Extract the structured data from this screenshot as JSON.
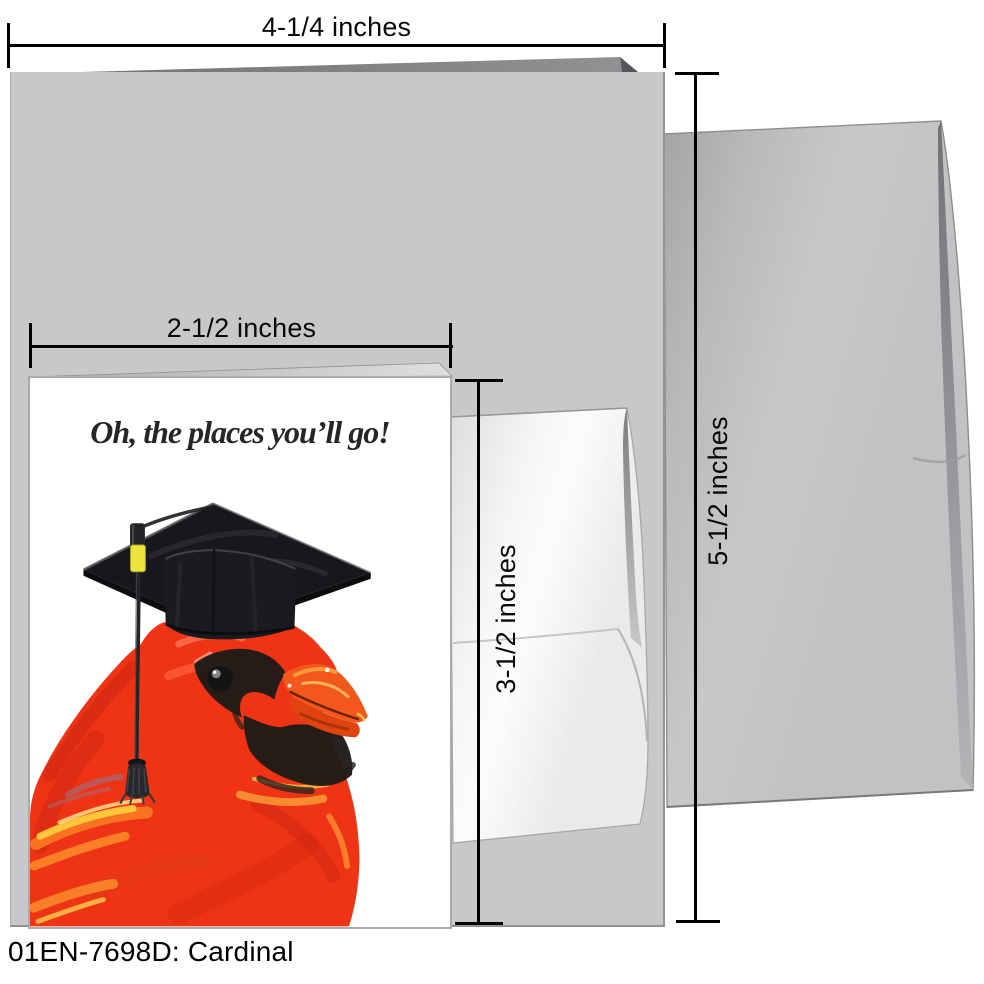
{
  "product": {
    "code": "01EN-7698D: Cardinal"
  },
  "card_front": {
    "headline": "Oh, the places you’ll go!",
    "illustration": "red cardinal wearing a black graduation mortarboard cap with tassel"
  },
  "measurements": {
    "large_card_width": "4-1/4 inches",
    "large_card_height": "5-1/2 inches",
    "small_card_width": "2-1/2 inches",
    "small_card_height": "3-1/2 inches"
  },
  "colors": {
    "background": "#ffffff",
    "large_card_gray": "#c7c8ca",
    "large_envelope_gray": "#bfc0c2",
    "small_envelope_white": "#f6f6f7",
    "dimension_line_black": "#000000",
    "cardinal_red": "#ee3414",
    "beak_orange": "#f2581c",
    "cap_black": "#17181b",
    "tassel_yellow": "#ece33c",
    "headline_text": "#262626"
  }
}
